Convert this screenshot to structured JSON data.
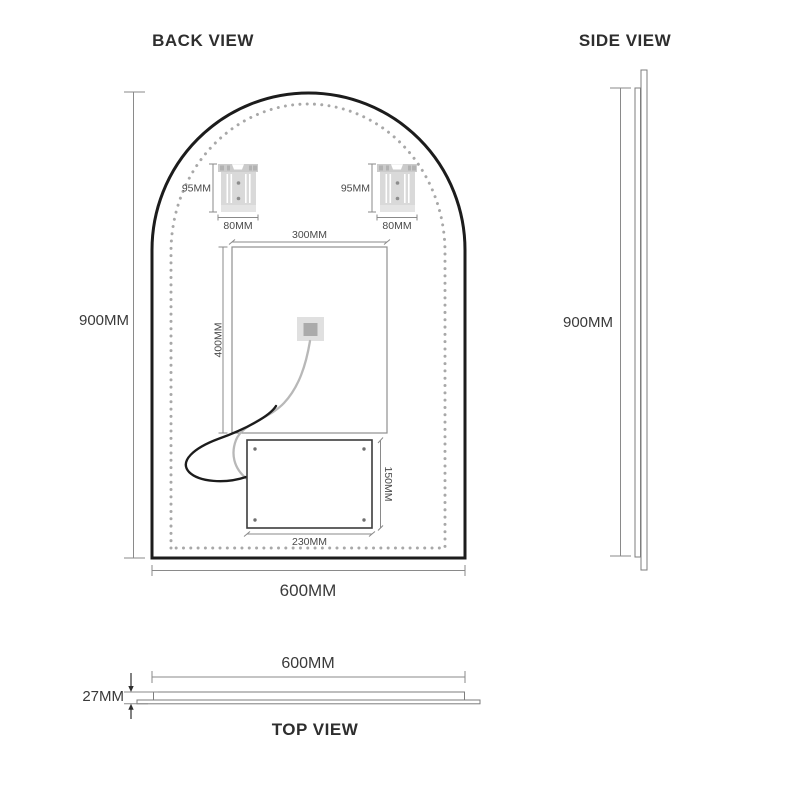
{
  "drawing": {
    "back_view": {
      "title": "BACK VIEW",
      "overall_height": "900MM",
      "overall_width": "600MM",
      "bracket_height": "95MM",
      "bracket_width": "80MM",
      "demister_width": "300MM",
      "demister_height": "400MM",
      "junction_box_width": "230MM",
      "junction_box_height": "150MM"
    },
    "side_view": {
      "title": "SIDE VIEW",
      "overall_height": "900MM"
    },
    "top_view": {
      "title": "TOP VIEW",
      "overall_width": "600MM",
      "thickness": "27MM"
    }
  },
  "colors": {
    "mirror_outline": "#1c1c1c",
    "led_dots": "#a8a8a8",
    "dimension_lines": "#8a8a8a",
    "label_text": "#3a3a3a",
    "bracket_fill": "#d9d9d9",
    "junction_box_stroke": "#3c3c3c",
    "sensor_cable": "#b8b8b8",
    "power_cable": "#1c1c1c",
    "connector_fill": "#e0e0e0",
    "connector_core": "#ababab"
  }
}
